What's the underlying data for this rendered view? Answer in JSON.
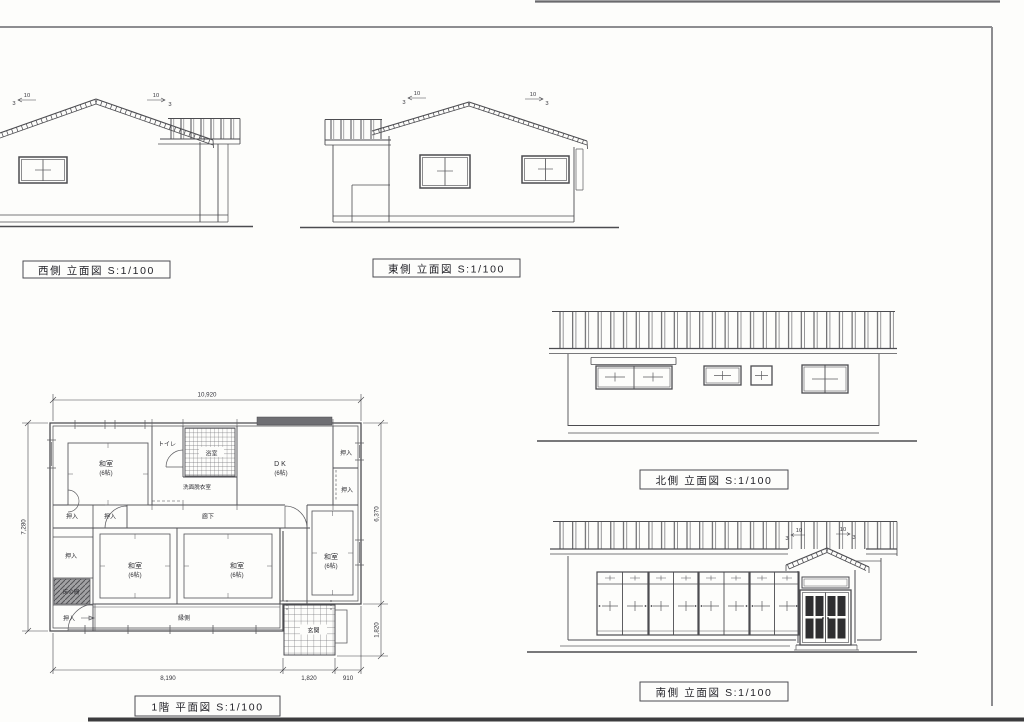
{
  "sheet": {
    "paper_color": "#fdfdfb",
    "line_color": "#4c4c50",
    "border_color": "#8d8d90"
  },
  "elevations": {
    "west": {
      "title": "西側 立面図 S:1/100",
      "slopes": [
        {
          "rise": "10",
          "run": "3"
        },
        {
          "rise": "10",
          "run": "3"
        }
      ]
    },
    "east": {
      "title": "東側 立面図 S:1/100",
      "slopes": [
        {
          "rise": "10",
          "run": "3"
        },
        {
          "rise": "10",
          "run": "3"
        }
      ]
    },
    "north": {
      "title": "北側 立面図 S:1/100"
    },
    "south": {
      "title": "南側 立面図 S:1/100",
      "slopes": [
        {
          "rise": "10",
          "run": "3"
        },
        {
          "rise": "10",
          "run": "3"
        }
      ]
    }
  },
  "floor_plan": {
    "title": "1階 平面図 S:1/100",
    "rooms": {
      "washitsu": [
        {
          "name": "和室",
          "size": "(6帖)"
        },
        {
          "name": "和室",
          "size": "(6帖)"
        },
        {
          "name": "和室",
          "size": "(6帖)"
        },
        {
          "name": "和室",
          "size": "(6帖)"
        }
      ],
      "dk": {
        "name": "DK",
        "size": "(6帖)"
      },
      "toilet": "トイレ",
      "bath": "浴室",
      "washroom": "洗面脱衣室",
      "corridor": "廊下",
      "tokonoma": "床の間",
      "engawa": "縁側",
      "genkan": "玄関",
      "closets": [
        "押入",
        "押入",
        "押入",
        "押入",
        "押入",
        "押入"
      ]
    },
    "dimensions": {
      "overall_width": "10,920",
      "left_depth": "7,280",
      "right_depth": "6,370",
      "genkan_depth": "1,820",
      "bottom_main": "8,190",
      "bottom_genkan": "1,820",
      "bottom_step": "910"
    }
  }
}
